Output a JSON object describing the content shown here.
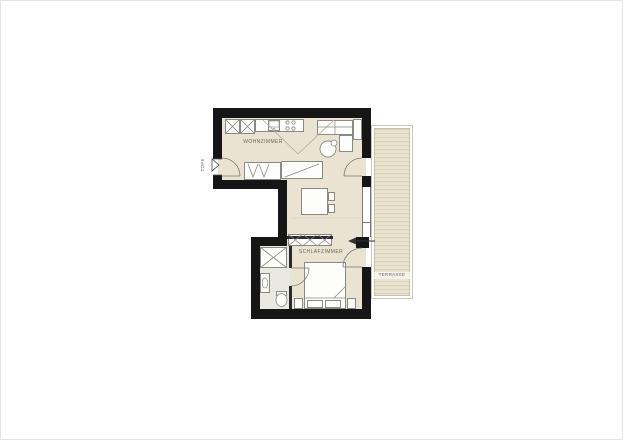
{
  "plan": {
    "unit_label": "TOP5",
    "rooms": [
      {
        "name": "living-room",
        "label": "WOHNZIMMER"
      },
      {
        "name": "bedroom",
        "label": "SCHLAFZIMMER"
      },
      {
        "name": "terrace",
        "label": "TERRASSE"
      }
    ]
  },
  "colors": {
    "wall": "#161616",
    "floor": "#eae3d2",
    "bathroom_floor": "#e9e8e1",
    "terrace_deck": "#e9e2cf",
    "terrace_line": "#d8d0ba",
    "furniture_fill": "#fdfdfb",
    "furniture_stroke": "#8a8a84",
    "label_text": "#6b6557"
  }
}
